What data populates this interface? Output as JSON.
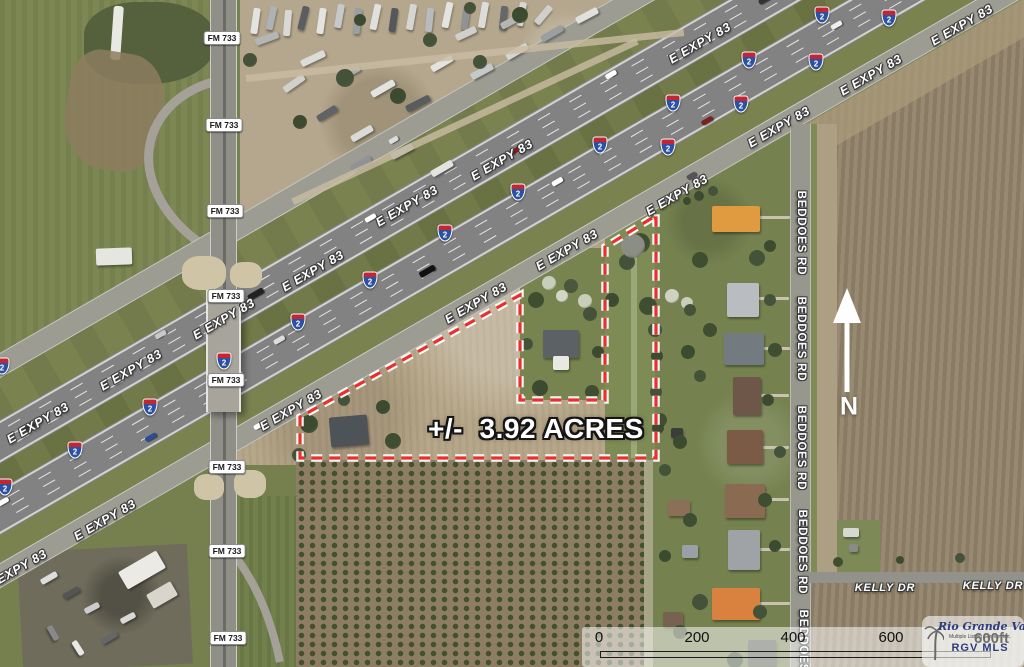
{
  "property": {
    "acreage_label": "+/-  3.92 ACRES"
  },
  "roads": {
    "expressway": "E EXPY 83",
    "farm_road": "FM 733",
    "beddoes": "BEDDOES RD",
    "kelly": "KELLY DR"
  },
  "interstate_shield": {
    "number": "2"
  },
  "compass": {
    "north_label": "N"
  },
  "scale_bar": {
    "ticks": [
      "0",
      "200",
      "400",
      "600"
    ],
    "unit_label": "600ft"
  },
  "logo": {
    "org_name": "Rio Grande Valley",
    "org_subtitle": "Multiple Listing Service, Inc.",
    "org_abbr": "RGV MLS"
  },
  "colors": {
    "boundary_red": "#e8312e",
    "boundary_halo": "#ffffff",
    "shield_blue": "#2b51a3",
    "shield_red": "#c22533",
    "logo_navy": "#2c3c80"
  }
}
